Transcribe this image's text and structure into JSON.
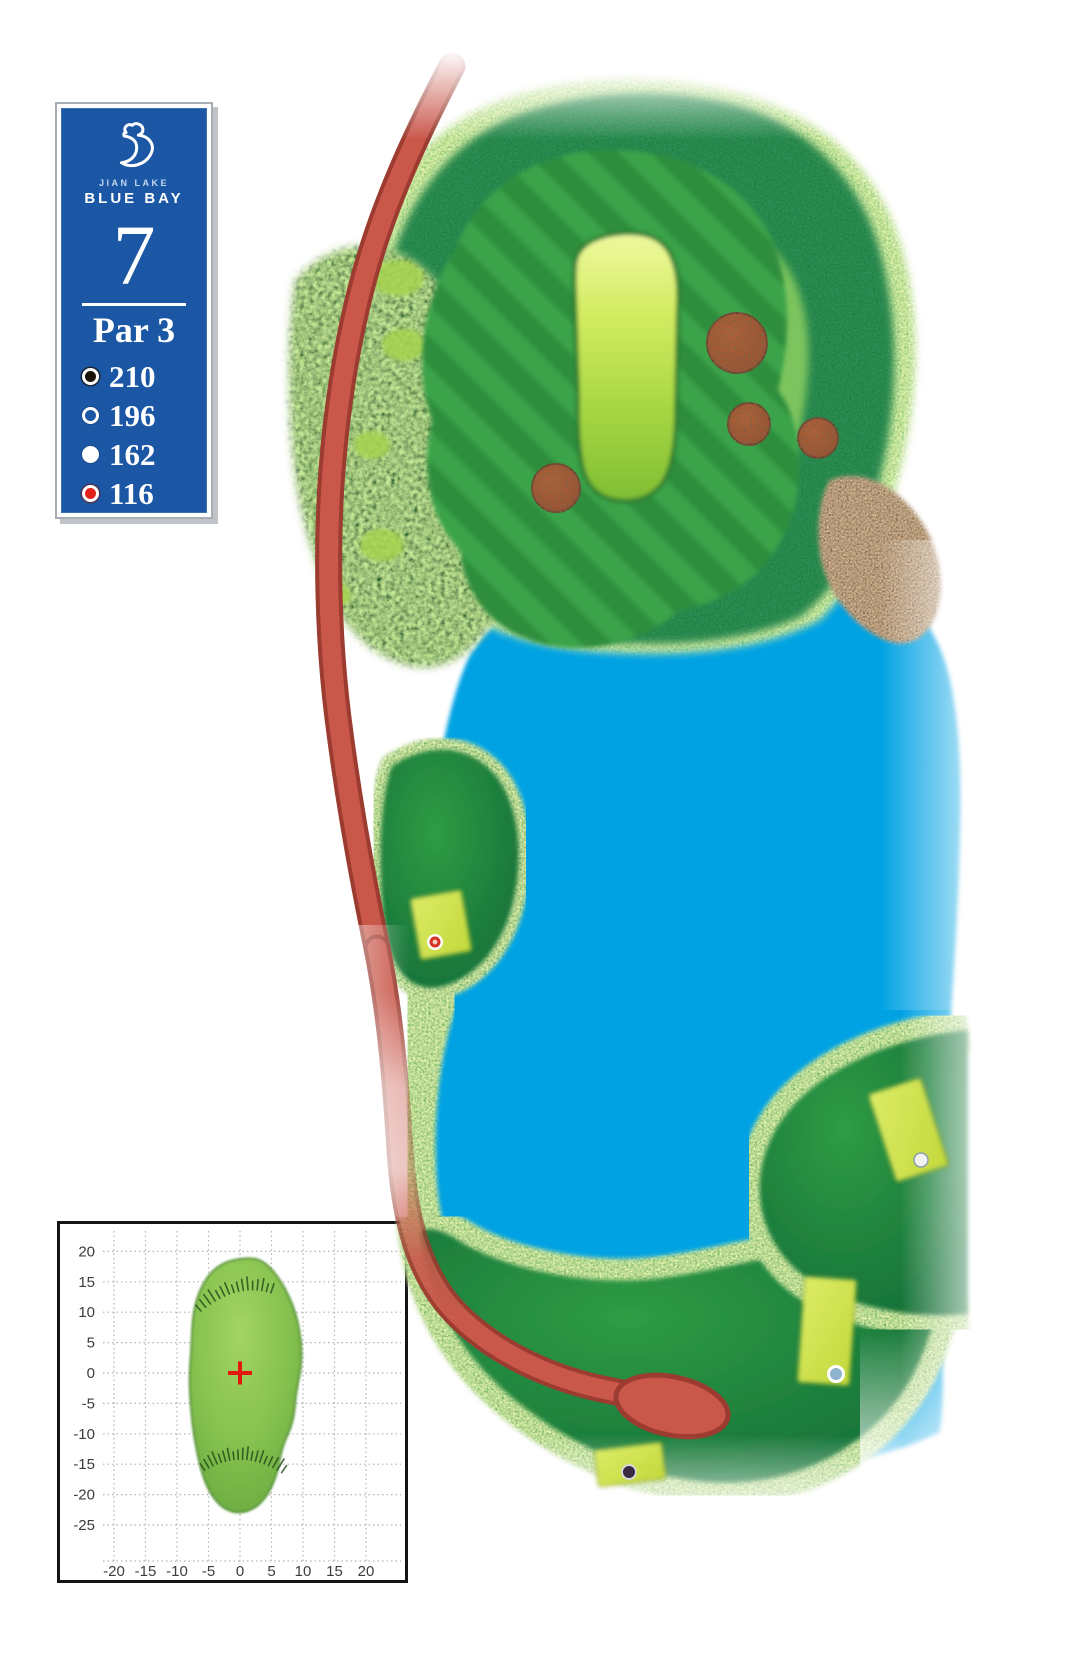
{
  "page": {
    "background": "#FFFFFF",
    "width": 1080,
    "height": 1676
  },
  "scorecard": {
    "club_name_line1": "JIAN LAKE",
    "club_name_line2": "BLUE BAY",
    "hole_number": "7",
    "par_label": "Par 3",
    "panel_color": "#1B57A4",
    "frame_color": "#A7ADB5",
    "tees": [
      {
        "id": "black",
        "distance": "210",
        "marker_style": "black circle, white ring"
      },
      {
        "id": "white-outline",
        "distance": "196",
        "marker_style": "hollow circle, white ring"
      },
      {
        "id": "white",
        "distance": "162",
        "marker_style": "solid white circle"
      },
      {
        "id": "red",
        "distance": "116",
        "marker_style": "red circle, white ring"
      }
    ]
  },
  "course_map": {
    "hole": "7",
    "features": {
      "lake_color": "#00A2E3",
      "cart_path_color": "#C9584B",
      "cart_path_edge_color": "#9C3B2F",
      "bunker_color": "#BE4E1C",
      "sand_beach_color": "#E6C7A1",
      "putting_green_color": "#BFE14A",
      "fairway_stripe_light": "#3AA348",
      "fairway_stripe_dark": "#2E8E3D",
      "rough_dark": "#167B37",
      "rough_light": "#74C162",
      "tee_box_color": "#D3E44F"
    },
    "bunker_count": 4,
    "tee_boxes": [
      {
        "tee": "red",
        "distance": "116",
        "location": "left knob beside lake"
      },
      {
        "tee": "white",
        "distance": "162",
        "location": "right peninsula"
      },
      {
        "tee": "white-outline",
        "distance": "196",
        "location": "lower right fairway"
      },
      {
        "tee": "black",
        "distance": "210",
        "location": "bottom fairway"
      }
    ]
  },
  "chart_data": {
    "type": "scatter",
    "title": "",
    "xlabel": "",
    "ylabel": "",
    "grid": "dotted",
    "x_ticks": [
      -20,
      -15,
      -10,
      -5,
      0,
      5,
      10,
      15,
      20
    ],
    "y_ticks": [
      20,
      15,
      10,
      5,
      0,
      -5,
      -10,
      -15,
      -20,
      -25
    ],
    "xlim": [
      -29,
      26.5
    ],
    "ylim": [
      -34.5,
      24.5
    ],
    "center_marker": {
      "x": 0,
      "y": 0,
      "shape": "cross",
      "color": "#E3170D"
    },
    "green_outline": [
      [
        0,
        18.8
      ],
      [
        2.6,
        18.9
      ],
      [
        4.6,
        17.6
      ],
      [
        6.3,
        15.4
      ],
      [
        7.8,
        12.6
      ],
      [
        8.9,
        9.6
      ],
      [
        9.5,
        6.6
      ],
      [
        9.8,
        3.8
      ],
      [
        9.7,
        1.0
      ],
      [
        9.2,
        -1.6
      ],
      [
        8.8,
        -4.2
      ],
      [
        8.6,
        -6.8
      ],
      [
        8.0,
        -9.2
      ],
      [
        7.0,
        -11.4
      ],
      [
        6.4,
        -13.6
      ],
      [
        6.0,
        -16.0
      ],
      [
        5.2,
        -18.4
      ],
      [
        4.0,
        -20.6
      ],
      [
        2.4,
        -22.2
      ],
      [
        0.4,
        -23.0
      ],
      [
        -1.6,
        -22.8
      ],
      [
        -3.4,
        -21.6
      ],
      [
        -4.8,
        -19.6
      ],
      [
        -5.8,
        -17.2
      ],
      [
        -6.5,
        -14.6
      ],
      [
        -7.0,
        -12.0
      ],
      [
        -7.4,
        -9.4
      ],
      [
        -7.7,
        -6.8
      ],
      [
        -7.9,
        -4.0
      ],
      [
        -8.0,
        -1.2
      ],
      [
        -7.9,
        1.6
      ],
      [
        -7.7,
        4.4
      ],
      [
        -7.6,
        7.2
      ],
      [
        -7.4,
        9.8
      ],
      [
        -6.8,
        12.4
      ],
      [
        -5.8,
        14.8
      ],
      [
        -4.4,
        16.8
      ],
      [
        -2.4,
        18.2
      ]
    ],
    "slope_hatches": [
      {
        "from": [
          -6.2,
          10.2
        ],
        "via": [
          -0.5,
          15.0
        ],
        "to": [
          4.9,
          13.2
        ],
        "count": 16,
        "len": 1.7,
        "dir": 1
      },
      {
        "from": [
          -5.6,
          -16.0
        ],
        "via": [
          0.3,
          -12.2
        ],
        "to": [
          6.6,
          -16.4
        ],
        "count": 19,
        "len": 1.7,
        "dir": 1
      }
    ]
  }
}
